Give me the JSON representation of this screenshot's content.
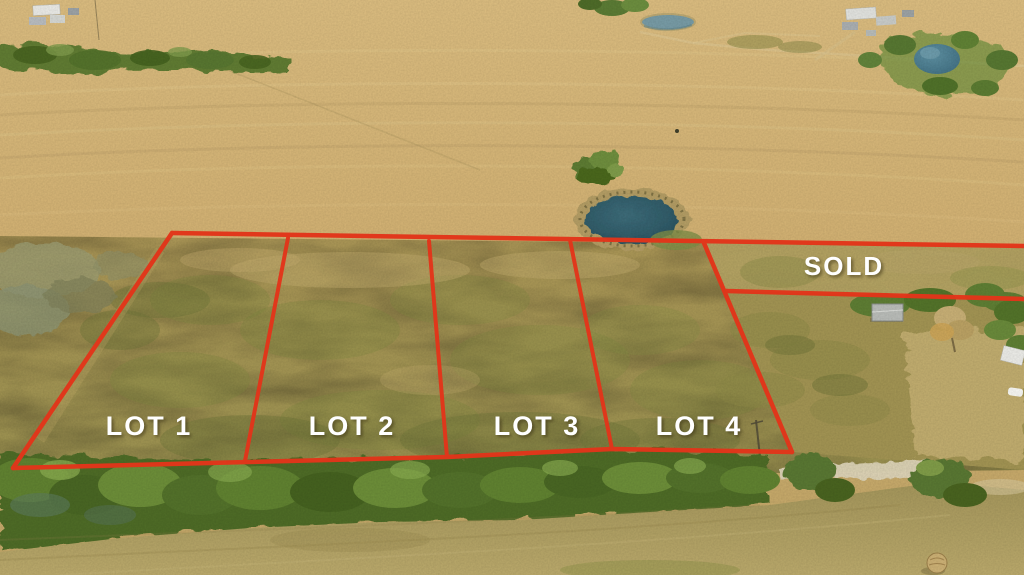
{
  "overlay": {
    "boundary_color": "#e2351a",
    "label_color": "#ffffff",
    "lots": [
      {
        "label": "LOT 1"
      },
      {
        "label": "LOT 2"
      },
      {
        "label": "LOT 3"
      },
      {
        "label": "LOT 4"
      }
    ],
    "sold": {
      "label": "SOLD"
    }
  },
  "scene": {
    "description": "Aerial drone photo of dry tan pasture divided into four red-outlined lots, with a stock pond, tree lines, farm buildings, a sold parcel, a dirt road and a hay bale",
    "palette": {
      "field_tan": "#cfae72",
      "lot_olive": "#a3914f",
      "tree_green": "#5d7a31",
      "pond_teal": "#33606c",
      "road_tan": "#dbd2b6"
    }
  }
}
